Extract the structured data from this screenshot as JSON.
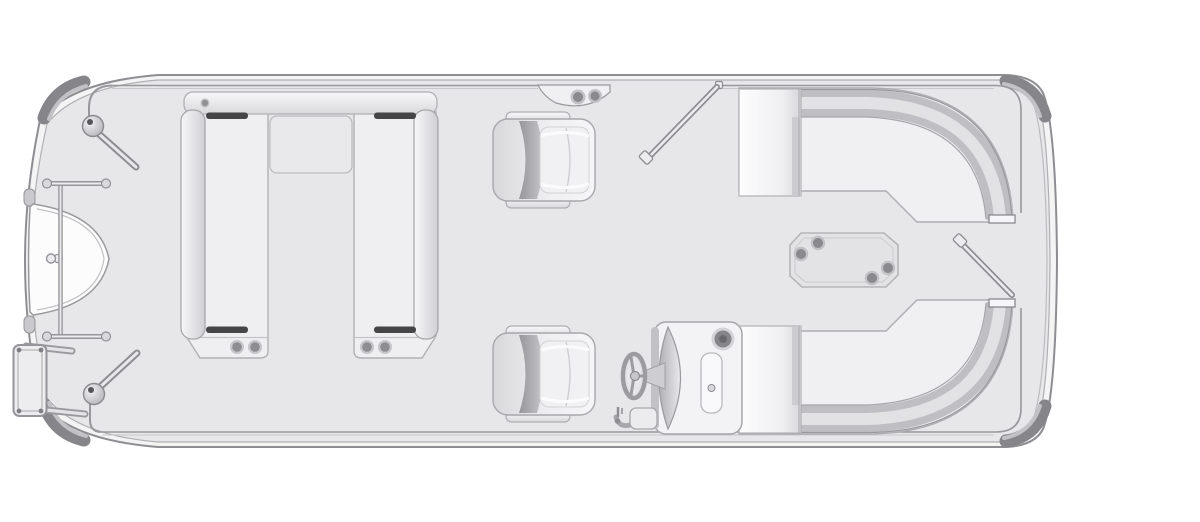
{
  "meta": {
    "title": "Pontoon boat deck plan (top view)",
    "view": "top-down floor plan line drawing",
    "orientation": "bow at left, stern at right"
  },
  "colors": {
    "page_bg": "#ffffff",
    "deck": "#e7e7e9",
    "hull_band": "#f4f4f5",
    "hull_outline": "#8e8e92",
    "deck_inner_line": "#b0b0b4",
    "rail": "#98989c",
    "rail_light": "#c9c9cd",
    "bumper": "#85858a",
    "bumper_highlight": "#c2c2c6",
    "nose": "#fcfcfd",
    "cushion": "#f0f0f2",
    "cushion_stroke": "#aeaeb2",
    "cushion_bright": "#fdfdfe",
    "seat_band": "#bfbfc3",
    "seat_band_highlight": "#e2e2e4",
    "handle": "#454548",
    "speaker": "#8e8e92",
    "speaker_ring": "#c6c6ca",
    "chair_body": "#f3f3f5",
    "chair_band": "#9c9ca0",
    "console": "#f3f3f5",
    "gauge": "#85858a",
    "table": "#e3e3e5",
    "table_stroke": "#b6b6b8",
    "table_dot": "#8a8a8e"
  },
  "components": {
    "hull": {
      "name": "pontoon deck with rounded stern corners and tapered bow",
      "corner_bumpers": 4
    },
    "bow": {
      "nose_platform": "white D-shaped nose cone at left",
      "gate": "bow gate frame with two ball-end mounting bars",
      "hinges": 2,
      "boarding_ladder": {
        "position": "port bow, outside hull",
        "mount_arms": 2
      }
    },
    "twin_lounges": {
      "description": "two facing bench lounges joined by a head bolster bar",
      "grab_handles": 4,
      "foot_speakers": 4,
      "center_panel": 1
    },
    "captain_chairs": {
      "count": 2,
      "facing": "stern"
    },
    "helm": {
      "console": "helm console with curved fascia",
      "steering_wheel": 1,
      "gauge": 1,
      "instrument_panel": 1,
      "throttle_lever": 1
    },
    "stern_lounges": {
      "count": 2,
      "description": "mirrored wrap-around corner lounges with backrest bands and end caps"
    },
    "table": {
      "shape": "octagonal",
      "cup_holders": 4
    },
    "gates_open": {
      "midship_top": 1,
      "stern": 1
    },
    "speaker_bracket": {
      "position": "top rail near midship gate",
      "speakers": 2
    }
  }
}
